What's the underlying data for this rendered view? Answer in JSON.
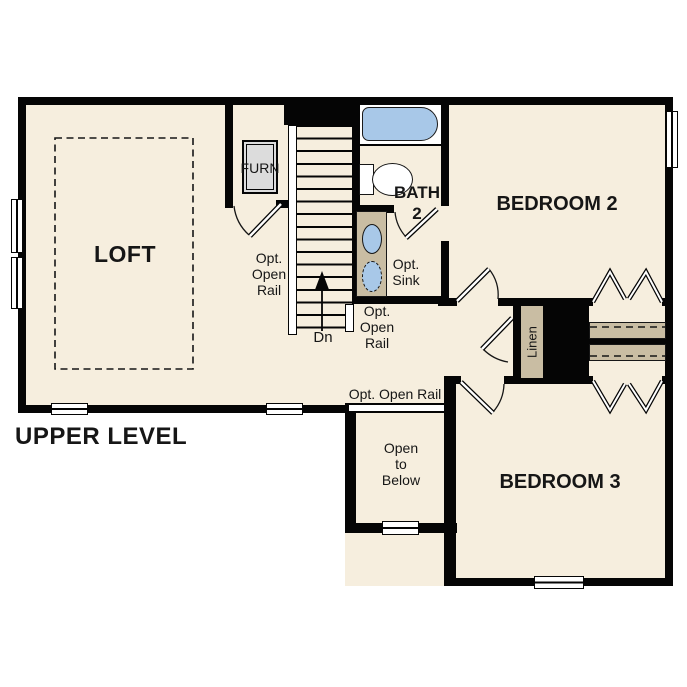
{
  "plan": {
    "title": "UPPER LEVEL",
    "labels": {
      "loft": "LOFT",
      "furnace": "FURN",
      "bath": "BATH\n2",
      "opt_sink": "Opt.\nSink",
      "bedroom2": "BEDROOM 2",
      "bedroom3": "BEDROOM 3",
      "linen": "Linen",
      "open_to_below": "Open\nto\nBelow",
      "down": "Dn",
      "opt_open_rail_left": "Opt.\nOpen\nRail",
      "opt_open_rail_right": "Opt.\nOpen\nRail",
      "opt_open_rail_inline": "Opt. Open Rail"
    },
    "colors": {
      "wall": "#050505",
      "floor": "#f6eede",
      "cabinet_tan": "#c9bda3",
      "fixture_blue": "#a8c8e8",
      "furnace_gray": "#dcdcdc",
      "text": "#161616",
      "background": "#ffffff"
    }
  }
}
